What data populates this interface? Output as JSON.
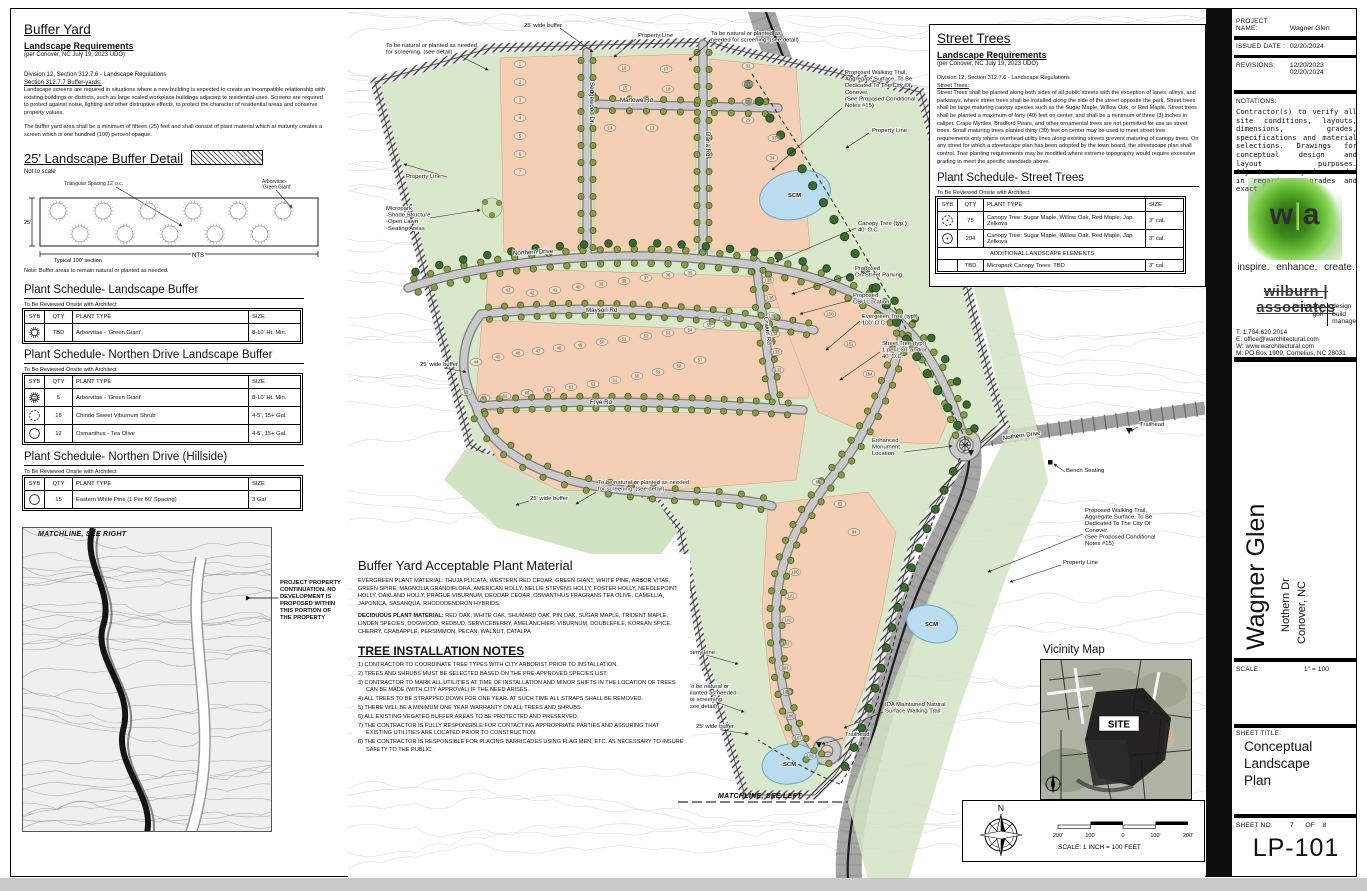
{
  "left_panel": {
    "buffer_yard": {
      "title": "Buffer Yard",
      "subtitle": "Landscape Requirements",
      "per_note": "(per Conover, NC July 19, 2023 UDO)",
      "division": "Division 12, Section 312.7.6 - Landscape Regulations",
      "section": "Section 312.7.7 Buffer-yards:",
      "para1": "Landscape screens are required in situations where a new building is expected to create an incompatible relationship with existing buildings or districts, such as large scaled workplace buildings adjacent to residential uses.  Screens are required to protect against noise, lighting and other distruptive effects, to protect the character of residential areas and conserve property values.",
      "para2": "The buffer yard area shall be a minimum of fifteen (25) feet and shall consist of plant material which at maturity creates a screen which is one hundred (100) percent opaque."
    },
    "buffer_detail": {
      "title": "25' Landscape Buffer Detail",
      "not_to_scale": "Not to scale",
      "callout_spacing": "Triangular Spacing 12' o.c.",
      "callout_arborvitae": "Arborvitae-\n'Green Giant'",
      "dim_left": "25'",
      "dim_bottom": "Typical 100' section",
      "nts": "NTS",
      "note": "Note:  Buffer areas to remain natural or planted as needed."
    },
    "matchline_right": "MATCHLINE,  SEE RIGHT",
    "project_note": "PROJECT PROPERTY\nCONTINUATION.  NO\nDEVELOPMENT IS\nPROPOSED WITHIN\nTHIS PORTION OF\nTHE PROPERTY",
    "schedules": [
      {
        "title": "Plant Schedule- Landscape Buffer",
        "note": "To Be Reviewed Onsite with Architect",
        "headers": [
          "SYB",
          "QTY",
          "PLANT TYPE",
          "SIZE"
        ],
        "rows": [
          {
            "sym": "arborvitae",
            "qty": "TBD",
            "type": "Arborvitae - 'Green Giant'",
            "size": "8-10' Ht. Min."
          }
        ]
      },
      {
        "title": "Plant Schedule- Northen Drive Landscape Buffer",
        "note": "To Be Reviewed Onsite with Architect",
        "headers": [
          "SYB",
          "QTY",
          "PLANT TYPE",
          "SIZE"
        ],
        "rows": [
          {
            "sym": "arborvitae-hatch",
            "qty": "5",
            "type": "Arborvitae - 'Green Giant'",
            "size": "8-10' Ht. Min."
          },
          {
            "sym": "shrub",
            "qty": "18",
            "type": "Chindo Sweet Viburnum Shrub",
            "size": "4-5', 15+ Gal."
          },
          {
            "sym": "circle",
            "qty": "12",
            "type": "Osmanthus - Tea Olive",
            "size": "4-5', 15+ Gal."
          }
        ]
      },
      {
        "title": "Plant Schedule- Northen Drive (Hillside)",
        "note": "To Be Reviewed Onsite with Architect",
        "headers": [
          "SYB",
          "QTY",
          "PLANT TYPE",
          "SIZE"
        ],
        "rows": [
          {
            "sym": "circle",
            "qty": "15",
            "type": "Eastern White Pine (1 Per 60' Spacing)",
            "size": "3 Gal"
          }
        ]
      }
    ]
  },
  "street_trees_panel": {
    "title": "Street Trees",
    "subtitle": "Landscape Requirements",
    "per_note": "(per Conover, NC July 19, 2023 UDO)",
    "division": "Division 12, Section 312.7.6 - Landscape Regulations",
    "section": "Street Trees:",
    "para": "Street Trees shall be planted along both sides of all public streets with the exception of lanes, alleys, and parkways, where street trees shall be installed along the side of the street opposite the park.  Street trees shall be large maturing canopy species such as the Sugar Maple, Willow Oak, or Red Maple.  Street trees shall be planted a maximum of forty (40) feet on center, and shall be a minimum of three (3) inches in caliper.  Crape Myrtles, Bradford Pears, and other ornamental trees are not permitted for use as street trees.  Small maturing trees planted thirty (30) feet on center may be used to meet street tree requirements only where overhead utility lines along existing streets prevent maturing of canopy trees.  On any street for which a streetscape plan has been adopted by the town board, the streetscape plan shall control.  Tree planting requirements may be modified where extreme topography would require excessive grading to meet the specific standards above.",
    "schedule": {
      "title": "Plant Schedule- Street Trees",
      "note": "To Be Reviewed Onsite with Architect",
      "headers": [
        "SYB",
        "QTY",
        "PLANT TYPE",
        "SIZE"
      ],
      "rows": [
        {
          "sym": "canopy-dash",
          "qty": "75",
          "type": "Canopy Tree:  Sugar Maple, Willow Oak, Red Maple, Jap. Zelkova",
          "size": "3\" cal."
        },
        {
          "sym": "canopy",
          "qty": "204",
          "type": "Canopy Tree:  Sugar Maple, Willow Oak, Red Maple, Jap. Zelkova",
          "size": "3\" cal."
        },
        {
          "divider": "ADDITIONAL LANDSCAPE ELEMENTS"
        },
        {
          "sym": "none",
          "qty": "TBD",
          "type": "Micropark Canopy Trees:  TBD",
          "size": "3\" cal."
        }
      ]
    }
  },
  "notes_panel": {
    "title": "Buffer Yard Acceptable Plant Material",
    "evergreen_label": "EVERGREEN PLANT MATERIAL:",
    "evergreen_text": " THUJA PLICATA, WESTERN RED CEDAR, GREEN GIANT, WHITE PINE, ARBOR VITAE, GREEN SPIRE, MAGNOLIA GRANDIFLORA, AMERICAN HOLLY, NELLIE STEVENS HOLLY, FOSTER HOLLY, NEEDLEPOINT HOLLY, OAKLAND HOLLY, PRAGUE VIBURNUM, DEODAR CEDAR, OSMANTHUS FRAGRANS TEA OLIVE, CAMELLIA, JAPONICA, SASANQUA, RHODODENDRON HYBRIDS.",
    "deciduous_label": "DECIDUOUS PLANT MATERIAL:",
    "deciduous_text": " RED OAK, WHITE OAK, SHUMARD OAK, PIN OAK, SUGAR MAPLE, TRIDENT MAPLE, LINDEN SPECIES, DOGWOOD, REDBUD, SERVICEBERRY, AMELANCHIER, VIBURNUM, DOUBLEFILE, KOREAN SPICE, CHERRY, CRABAPPLE, PERSIMMON, PECAN, WALNUT, CATALPA",
    "tree_notes_title": "TREE INSTALLATION NOTES",
    "notes": [
      "1) CONTRACTOR TO COORDINATE TREE TYPES WITH CITY ARBORIST PRIOR TO INSTALLATION.",
      "2) TREES AND SHRUBS MUST BE SELECTED BASED ON THE PRE-APPROVED SPECIES LIST.",
      "3) CONTRACTOR TO MARK ALL UTILITIES AT TIME OF INSTALLATION AND MINOR SHIFTS IN THE LOCATION OF TREES CAN BE MADE (WITH CITY APPROVAL) IF THE NEED ARISES.",
      "4) ALL TREES TO BE STRAPPED DOWN FOR ONE YEAR. AT SUCH TIME ALL STRAPS SHALL BE REMOVED.",
      "5) THERE WILL BE A MINIMUM ONE YEAR WARRANTY ON ALL TREES AND SHRUBS.",
      "6) ALL EXISTING VEGATED BUFFER AREAS TO BE PROTECTED AND PRESERVED.",
      "7) THE CONTRACTOR IS FULLY RESPONSIBLE FOR CONTACTING APPROPRIATE PARTIES AND ASSURING THAT EXISTING UTILITIES ARE LOCATED PRIOR TO CONSTRUCTION.",
      "8) THE CONTRACTOR IS RESPONSIBLE FOR PLACING BARRICADES USING FLAG MEN, ETC. AS NECESSARY TO INSURE SAFETY TO THE PUBLIC."
    ]
  },
  "map": {
    "streets": {
      "sedgewood": "Sedgewood Dr",
      "marlowe": "Marlowe Rd",
      "dana": "Dana Rd",
      "northern": "Northern Drive",
      "mayson": "Mayson Rd",
      "frye": "Frye Rd",
      "craker": "Craker Rd",
      "nothern_existing": "Nothern Drive"
    },
    "annotations": {
      "buffer_top": "25' wide buffer",
      "property_line_top": "Property Line",
      "natural_top_right": "To be natural or planted as\nneeded for screening.  (see detail)",
      "natural_top_left": "To be natural or planted as needed\nfor screening.  (see detail)",
      "walking_trail_ne": "Proposed Walking Trail,\nAggregate  Surface, To Be\nDedicated To The City Of\nConover.\n(See Proposed Conditional\nNotes #15)",
      "property_line_e": "Property Line",
      "property_line_w": "Property Line",
      "micropark": "Micropark\n-Shade Structure\n-Open Lawn\n-Seating Areas",
      "canopy_tree": "Canopy Tree (typ.)\n40' O.C.",
      "onstreet_parking": "Proposed\nOn-Street Parking",
      "cbu": "Proposed\nCBU Location",
      "evergreen_tree": "Evergreen Tree (typ.)\n100' O.C.",
      "street_tree": "Street Tree (typ.)\n1 per LOT and/or\n40' O.C.",
      "buffer_mid": "25' wide buffer",
      "monument": "Enhanced\nMonument\nLocation",
      "trailhead_ne": "Trailhead",
      "bench": "Bench Seating",
      "buffer_sw": "25' wide buffer",
      "natural_mid": "To be natural or planted as needed\nfor screening.  (see detail)",
      "walking_trail_se": "Proposed Walking Trail,\nAggregate  Surface, To Be\nDedicated To The City Of\nConover.\n(See Proposed Conditional\nNotes #15)",
      "property_line_se": "Property Line",
      "property_line_s": "Property Line",
      "natural_s": "To be natural or\nplanted as needed\nfor screening.\n(see detail)",
      "ida_trail": "IDA Maintained Natural\nSurface Walking Trail",
      "buffer_s": "25' wide buffer",
      "trailhead_s": "Trailhead",
      "matchline_left": "MATCHLINE,  SEE LEFT",
      "scm": "SCM"
    },
    "lot_numbers": [
      {
        "n": "1",
        "x": 172,
        "y": 52
      },
      {
        "n": "2",
        "x": 172,
        "y": 70
      },
      {
        "n": "3",
        "x": 172,
        "y": 88
      },
      {
        "n": "4",
        "x": 172,
        "y": 106
      },
      {
        "n": "5",
        "x": 172,
        "y": 124
      },
      {
        "n": "6",
        "x": 172,
        "y": 142
      },
      {
        "n": "7",
        "x": 172,
        "y": 160
      },
      {
        "n": "16",
        "x": 276,
        "y": 56
      },
      {
        "n": "17",
        "x": 318,
        "y": 57
      },
      {
        "n": "15",
        "x": 277,
        "y": 76
      },
      {
        "n": "18",
        "x": 320,
        "y": 77
      },
      {
        "n": "14",
        "x": 262,
        "y": 116
      },
      {
        "n": "13",
        "x": 304,
        "y": 116
      },
      {
        "n": "32",
        "x": 400,
        "y": 54
      },
      {
        "n": "31",
        "x": 400,
        "y": 72
      },
      {
        "n": "30",
        "x": 400,
        "y": 90
      },
      {
        "n": "29",
        "x": 400,
        "y": 108
      },
      {
        "n": "33",
        "x": 426,
        "y": 126
      },
      {
        "n": "34",
        "x": 424,
        "y": 146
      },
      {
        "n": "43",
        "x": 160,
        "y": 278
      },
      {
        "n": "42",
        "x": 184,
        "y": 281
      },
      {
        "n": "41",
        "x": 207,
        "y": 278
      },
      {
        "n": "40",
        "x": 230,
        "y": 275
      },
      {
        "n": "39",
        "x": 253,
        "y": 272
      },
      {
        "n": "38",
        "x": 276,
        "y": 269
      },
      {
        "n": "37",
        "x": 298,
        "y": 266
      },
      {
        "n": "36",
        "x": 320,
        "y": 263
      },
      {
        "n": "35",
        "x": 342,
        "y": 261
      },
      {
        "n": "44",
        "x": 128,
        "y": 350
      },
      {
        "n": "45",
        "x": 150,
        "y": 345
      },
      {
        "n": "46",
        "x": 170,
        "y": 341
      },
      {
        "n": "47",
        "x": 190,
        "y": 339
      },
      {
        "n": "48",
        "x": 211,
        "y": 336
      },
      {
        "n": "49",
        "x": 232,
        "y": 333
      },
      {
        "n": "50",
        "x": 254,
        "y": 330
      },
      {
        "n": "51",
        "x": 276,
        "y": 327
      },
      {
        "n": "52",
        "x": 298,
        "y": 324
      },
      {
        "n": "53",
        "x": 320,
        "y": 321
      },
      {
        "n": "54",
        "x": 342,
        "y": 318
      },
      {
        "n": "55",
        "x": 361,
        "y": 313
      },
      {
        "n": "56",
        "x": 377,
        "y": 307
      },
      {
        "n": "57",
        "x": 352,
        "y": 348
      },
      {
        "n": "58",
        "x": 331,
        "y": 354
      },
      {
        "n": "59",
        "x": 310,
        "y": 360
      },
      {
        "n": "60",
        "x": 289,
        "y": 364
      },
      {
        "n": "61",
        "x": 267,
        "y": 368
      },
      {
        "n": "62",
        "x": 245,
        "y": 372
      },
      {
        "n": "63",
        "x": 223,
        "y": 375
      },
      {
        "n": "64",
        "x": 201,
        "y": 378
      },
      {
        "n": "65",
        "x": 179,
        "y": 381
      },
      {
        "n": "66",
        "x": 157,
        "y": 384
      },
      {
        "n": "67",
        "x": 136,
        "y": 386
      },
      {
        "n": "68",
        "x": 118,
        "y": 380
      },
      {
        "n": "80",
        "x": 470,
        "y": 470
      },
      {
        "n": "82",
        "x": 492,
        "y": 492
      },
      {
        "n": "84",
        "x": 506,
        "y": 520
      },
      {
        "n": "100",
        "x": 447,
        "y": 560
      },
      {
        "n": "101",
        "x": 443,
        "y": 584
      },
      {
        "n": "102",
        "x": 440,
        "y": 608
      },
      {
        "n": "103",
        "x": 438,
        "y": 632
      },
      {
        "n": "104",
        "x": 437,
        "y": 656
      },
      {
        "n": "105",
        "x": 438,
        "y": 680
      },
      {
        "n": "106",
        "x": 442,
        "y": 704
      },
      {
        "n": "107",
        "x": 450,
        "y": 726
      },
      {
        "n": "108",
        "x": 462,
        "y": 744
      },
      {
        "n": "132",
        "x": 430,
        "y": 358
      },
      {
        "n": "133",
        "x": 428,
        "y": 340
      },
      {
        "n": "134",
        "x": 426,
        "y": 322
      },
      {
        "n": "135",
        "x": 424,
        "y": 304
      },
      {
        "n": "136",
        "x": 422,
        "y": 286
      },
      {
        "n": "138",
        "x": 420,
        "y": 268
      },
      {
        "n": "150",
        "x": 482,
        "y": 302
      },
      {
        "n": "152",
        "x": 502,
        "y": 332
      },
      {
        "n": "154",
        "x": 521,
        "y": 362
      }
    ]
  },
  "vicinity": {
    "title": "Vicinity Map",
    "site_label": "SITE"
  },
  "compass": {
    "n": "N",
    "ticks": [
      "200'",
      "100'",
      "0",
      "100'",
      "200'"
    ],
    "scale_text": "SCALE: 1 INCH = 100 FEET"
  },
  "titleblock": {
    "project_label": "PROJECT NAME:",
    "project_name": "Wagner Glen",
    "issued_label": "ISSUED DATE :",
    "issued_date": "02/20/2024",
    "revisions_label": "REVISIONS:",
    "revisions": "12/20/2023\n02/20/2024",
    "notations_label": "NOTATIONS:",
    "notations_text": "Contractor(s) to verify all site conditions, layouts, dimensions, grades, specifications and material selections. Drawings for conceptual design and layout purposes. Adjustments may be needed in regards to grades and exact layout.",
    "logo_w": "w",
    "logo_pipe": "|",
    "logo_a": "a",
    "tagline": "inspire.  enhance.  create.",
    "firm_name": "wilburn | associates",
    "services_left": "landscape\ngolf",
    "services_right": "design\nbuild\nmanage",
    "contacts": "T:   1.704.620.2014\nE:   office@warchitectural.com\nW:  www.warchitectural.com\nM:  PO Box 1909, Cornelius, NC 28031",
    "project_title": "Wagner Glen",
    "address1": "Nothern Dr",
    "address2": "Conover, NC",
    "scale_label": "SCALE:",
    "scale_value": "1\" = 100",
    "sheet_title_label": "SHEET TITLE:",
    "sheet_title": "Conceptual\nLandscape\nPlan",
    "sheet_no_label": "SHEET NO:",
    "sheet_no": "7",
    "of_label": "OF",
    "sheet_total": "8",
    "sheet_code": "LP-101"
  }
}
